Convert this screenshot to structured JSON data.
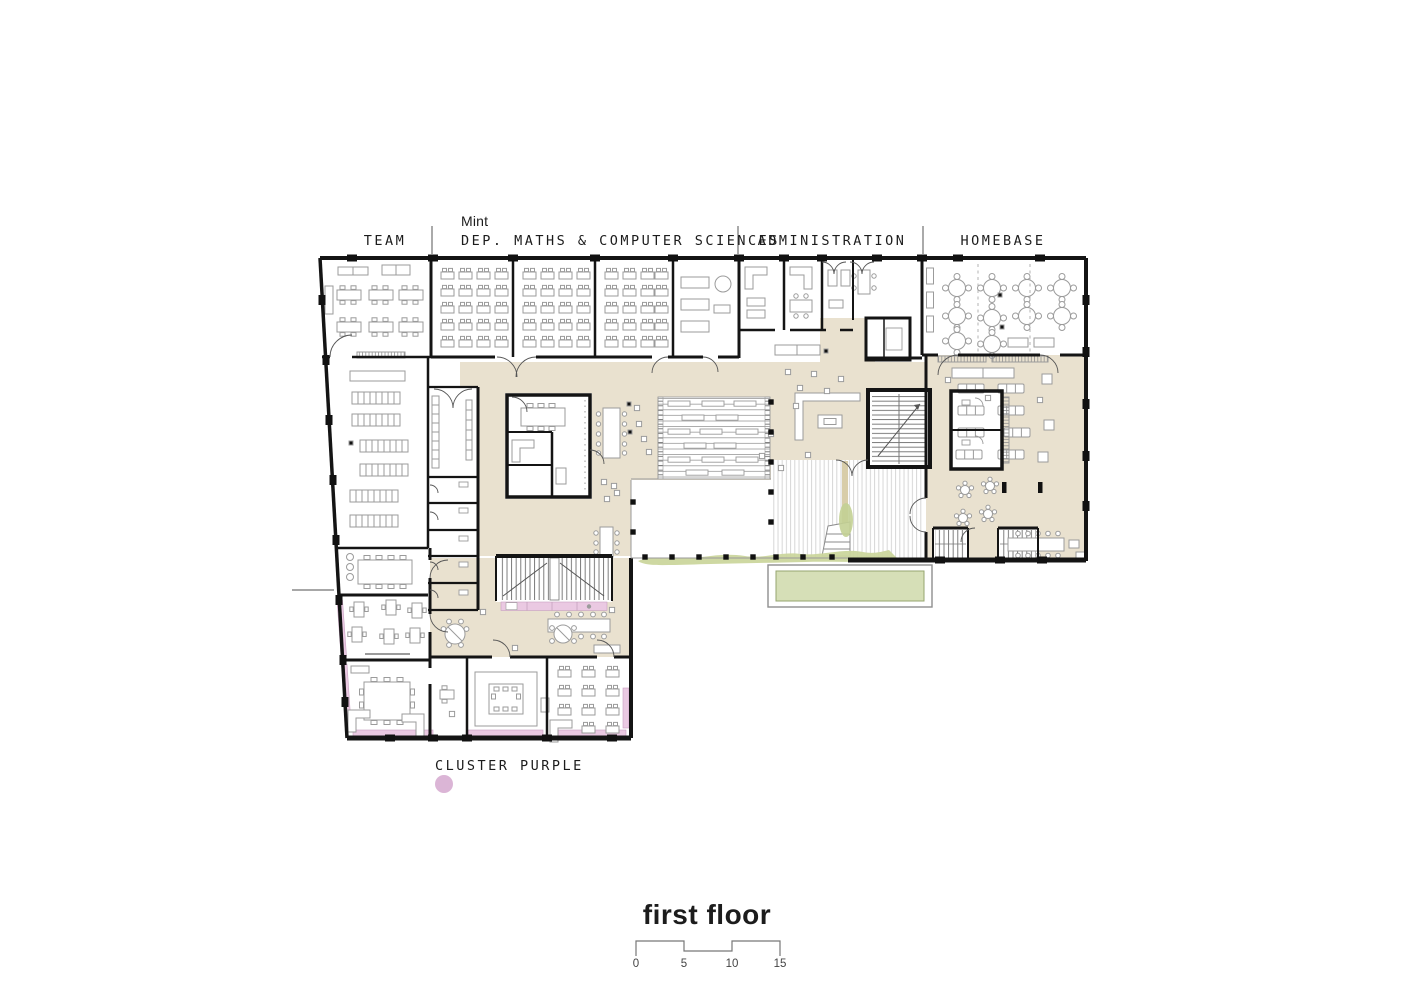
{
  "plan": {
    "title": "first floor",
    "zone_labels": {
      "team": "TEAM",
      "dep_sub": "Mint",
      "dep": "DEP. MATHS & COMPUTER SCIENCES",
      "administration": "ADMINISTRATION",
      "homebase": "HOMEBASE",
      "cluster": "CLUSTER PURPLE"
    },
    "scale_bar": {
      "ticks": [
        "0",
        "5",
        "10",
        "15"
      ]
    },
    "legend": {
      "cluster_marker_color": "#dbb5d6"
    },
    "colors": {
      "circulation_beige": "#e9e1cf",
      "cluster_pink": "#eac9e2",
      "water_green": "#d6dfb7",
      "planting_green": "#cbd69d",
      "wall_black": "#141414",
      "furniture_gray": "#9b9b9b"
    }
  }
}
